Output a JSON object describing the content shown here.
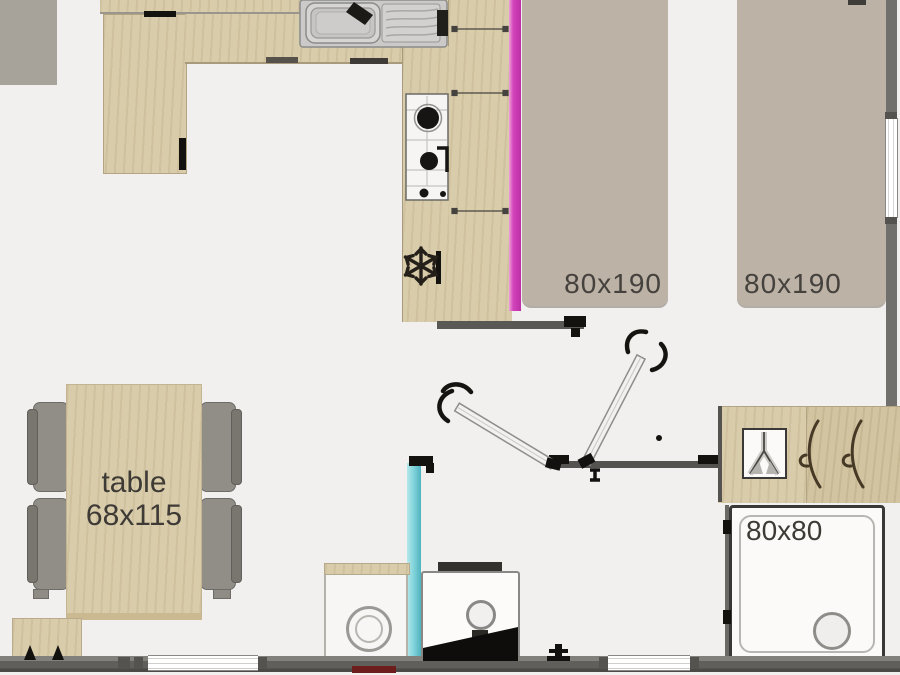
{
  "plan": {
    "bedroom": {
      "bed_left_label": "80x190",
      "bed_right_label": "80x190"
    },
    "living": {
      "table_label": "table",
      "table_size": "68x115"
    },
    "bathroom": {
      "shower_label": "80x80"
    },
    "icons": {
      "fridge": "snowflake-icon",
      "door_left": "open-door-icon",
      "door_right": "open-door-icon",
      "wardrobe": "hanger-hook-icon",
      "toilet": "toilet-icon",
      "sink": "kitchen-sink-icon",
      "stove": "stove-burners-icon",
      "shower_drain": "drain-icon"
    },
    "colors": {
      "background": "#f1f0ee",
      "wood": "#d9ccaa",
      "mattress": "#bcb2a6",
      "partition_magenta": "#c336ae",
      "partition_cyan": "#84d5dc",
      "wall_gray": "#6c6a66",
      "label_text": "#45413d",
      "accent_red": "#6e1d1d"
    }
  }
}
